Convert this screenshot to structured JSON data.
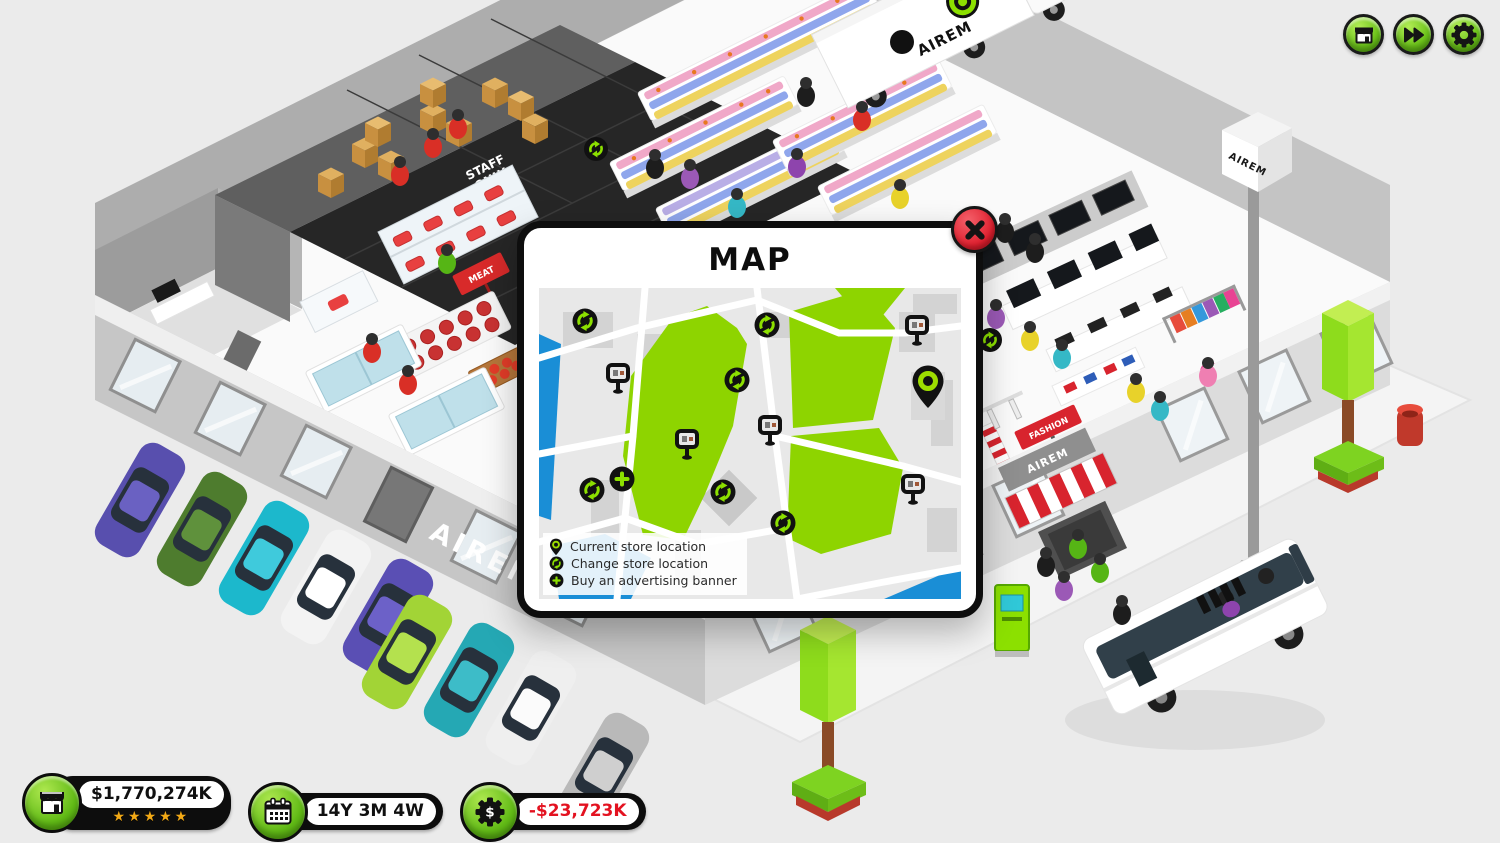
{
  "topbar": {
    "buttons": [
      {
        "id": "shop",
        "icon": "storefront-icon"
      },
      {
        "id": "fast-forward",
        "icon": "fast-forward-icon"
      },
      {
        "id": "settings",
        "icon": "gear-icon"
      }
    ]
  },
  "map_dialog": {
    "title": "MAP",
    "close_icon": "close-x",
    "legend": [
      {
        "icon": "current-location-pin-icon",
        "label": "Current store location"
      },
      {
        "icon": "change-location-icon",
        "label": "Change store location"
      },
      {
        "icon": "plus-icon",
        "label": "Buy an advertising banner"
      }
    ],
    "markers": [
      {
        "type": "change",
        "x": 46,
        "y": 33
      },
      {
        "type": "banner",
        "x": 79,
        "y": 90
      },
      {
        "type": "change",
        "x": 228,
        "y": 37
      },
      {
        "type": "change",
        "x": 198,
        "y": 92
      },
      {
        "type": "banner",
        "x": 148,
        "y": 156
      },
      {
        "type": "banner",
        "x": 231,
        "y": 142
      },
      {
        "type": "plus",
        "x": 83,
        "y": 191
      },
      {
        "type": "change",
        "x": 53,
        "y": 202
      },
      {
        "type": "change",
        "x": 184,
        "y": 204
      },
      {
        "type": "change",
        "x": 244,
        "y": 235
      },
      {
        "type": "banner",
        "x": 378,
        "y": 42
      },
      {
        "type": "pin",
        "x": 389,
        "y": 99
      },
      {
        "type": "banner",
        "x": 374,
        "y": 201
      }
    ]
  },
  "hud": {
    "balance": "$1,770,274K",
    "stars": "★★★★★",
    "date": "14Y 3M 4W",
    "profit": "-$23,723K"
  },
  "scene": {
    "brand": "AIREM",
    "staff_only_line1": "STAFF",
    "staff_only_line2": "ONLY",
    "meat_sign": "MEAT",
    "fashion_sign": "FASHION"
  },
  "colors": {
    "accent_green": "#7ec41c",
    "alert_red": "#df1f2e",
    "map_park": "#8ed400",
    "map_water": "#1a8ed6",
    "icon_green": "#8ce000"
  }
}
